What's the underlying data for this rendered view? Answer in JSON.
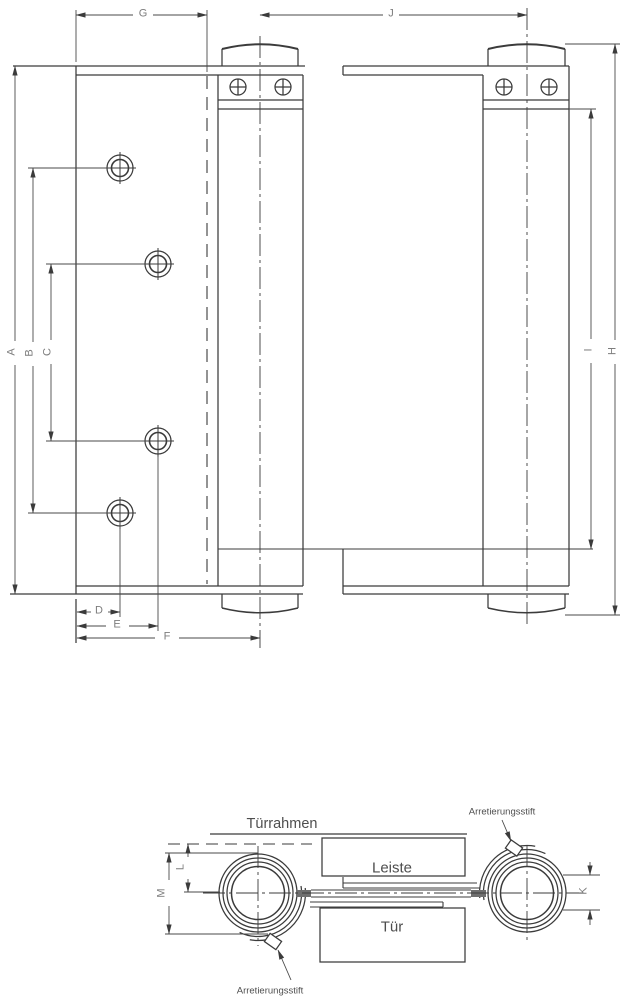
{
  "drawing": {
    "front_view_dims": {
      "G": "G",
      "J": "J",
      "A": "A",
      "B": "B",
      "C": "C",
      "D": "D",
      "E": "E",
      "F": "F",
      "I": "I",
      "H": "H"
    },
    "top_view_dims": {
      "M": "M",
      "L": "L",
      "K": "K"
    },
    "top_view_labels": {
      "door_frame": "Türrahmen",
      "strip": "Leiste",
      "door": "Tür",
      "locking_pin_top": "Arretierungsstift",
      "locking_pin_bottom": "Arretierungsstift"
    },
    "colors": {
      "line": "#3b3b3b",
      "dim_line": "#4a4a4a",
      "dim_text": "#7d7d7d",
      "label_text": "#4e4e4e",
      "bar_fill": "#6f6f6f",
      "background": "#ffffff"
    }
  }
}
